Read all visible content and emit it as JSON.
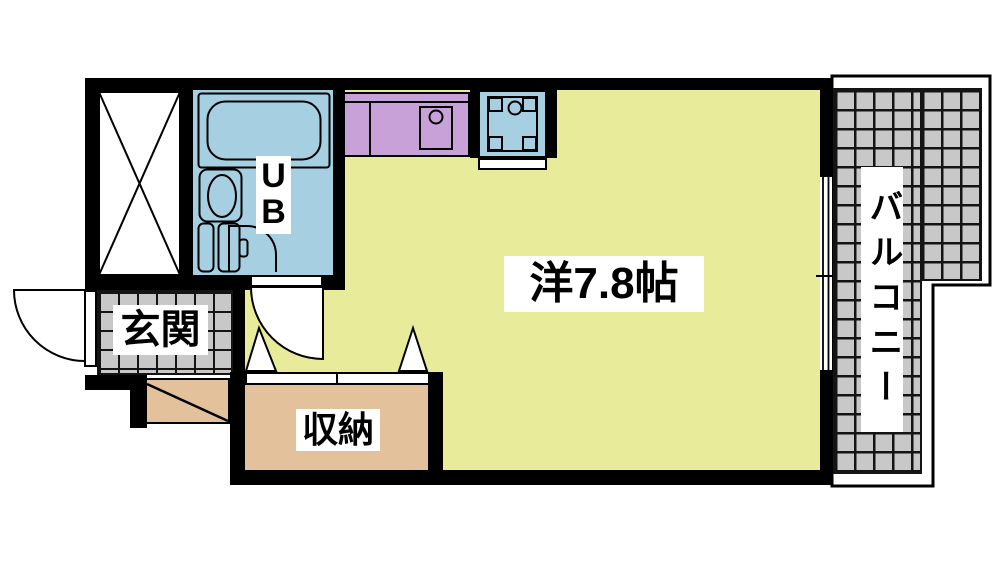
{
  "floorplan": {
    "labels": {
      "main_room": "洋7.8帖",
      "entrance": "玄関",
      "storage": "収納",
      "balcony": "バルコニー",
      "unit_bath_line1": "U",
      "unit_bath_line2": "B"
    },
    "colors": {
      "room_yellow": "#e7eb9a",
      "bath_blue": "#a6cfe2",
      "kitchen_purple": "#c9a1d9",
      "storage_tan": "#e2c19b",
      "tile_gray": "#c8c8c8",
      "wall_black": "#000000"
    }
  }
}
